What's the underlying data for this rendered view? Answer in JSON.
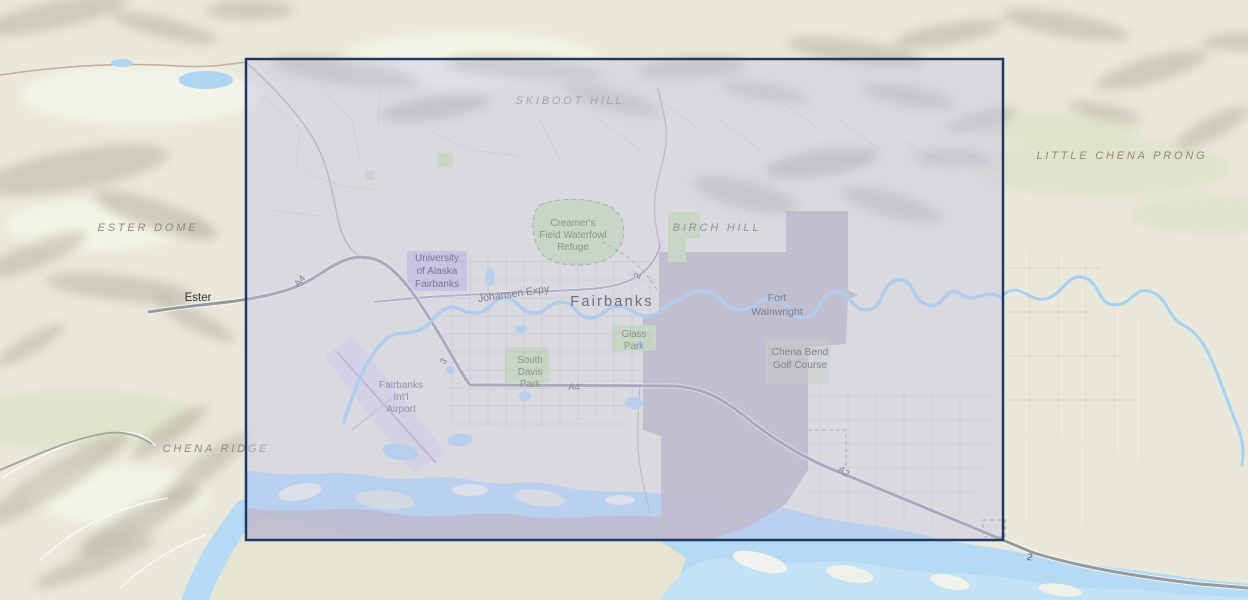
{
  "map": {
    "type": "topographic-basemap",
    "region": "Fairbanks, Alaska area",
    "colors": {
      "base_land": "#e9e8db",
      "lowland_tan": "#e7e4d1",
      "water": "#b4daf4",
      "water_light": "#c4e2f6",
      "river_stroke": "#a6d2f2",
      "park_green": "#cfe3ad",
      "military_gray": "#bab5bb",
      "campus_purple": "#c9bedd",
      "airport_lavender": "#dad7e5",
      "road_major": "#98989f",
      "road_minor": "#a6a6ae",
      "selection_fill": "#c4c4e8",
      "selection_border": "#1e3a62"
    },
    "selection": {
      "x": 246,
      "y": 59,
      "width": 757,
      "height": 481,
      "fill": "#c4c4e8",
      "fill_opacity": "0.42",
      "border_color": "#1e3a62",
      "border_width": "2.5"
    },
    "labels": {
      "skiboot_hill": "SKIBOOT HILL",
      "little_chena_prong": "LITTLE CHENA PRONG",
      "ester_dome": "ESTER DOME",
      "birch_hill": "BIRCH HILL",
      "chena_ridge": "CHENA RIDGE",
      "ester": "Ester",
      "fairbanks": "Fairbanks",
      "fort_wainwright": {
        "line1": "Fort",
        "line2": "Wainwright"
      },
      "university": {
        "line1": "University",
        "line2": "of Alaska",
        "line3": "Fairbanks"
      },
      "creamers": {
        "line1": "Creamer's",
        "line2": "Field Waterfowl",
        "line3": "Refuge"
      },
      "glass_park": {
        "line1": "Glass",
        "line2": "Park"
      },
      "south_davis_park": {
        "line1": "South",
        "line2": "Davis",
        "line3": "Park"
      },
      "airport": {
        "line1": "Fairbanks",
        "line2": "Int'l",
        "line3": "Airport"
      },
      "chena_bend": {
        "line1": "Chena Bend",
        "line2": "Golf Course"
      },
      "johansen_expy": "Johansen Expy",
      "route_a4_west": "A4",
      "route_a4_mid": "A4",
      "route_a2": "A2",
      "route_2_south": "2",
      "route_2_city": "2",
      "route_3": "3"
    }
  }
}
